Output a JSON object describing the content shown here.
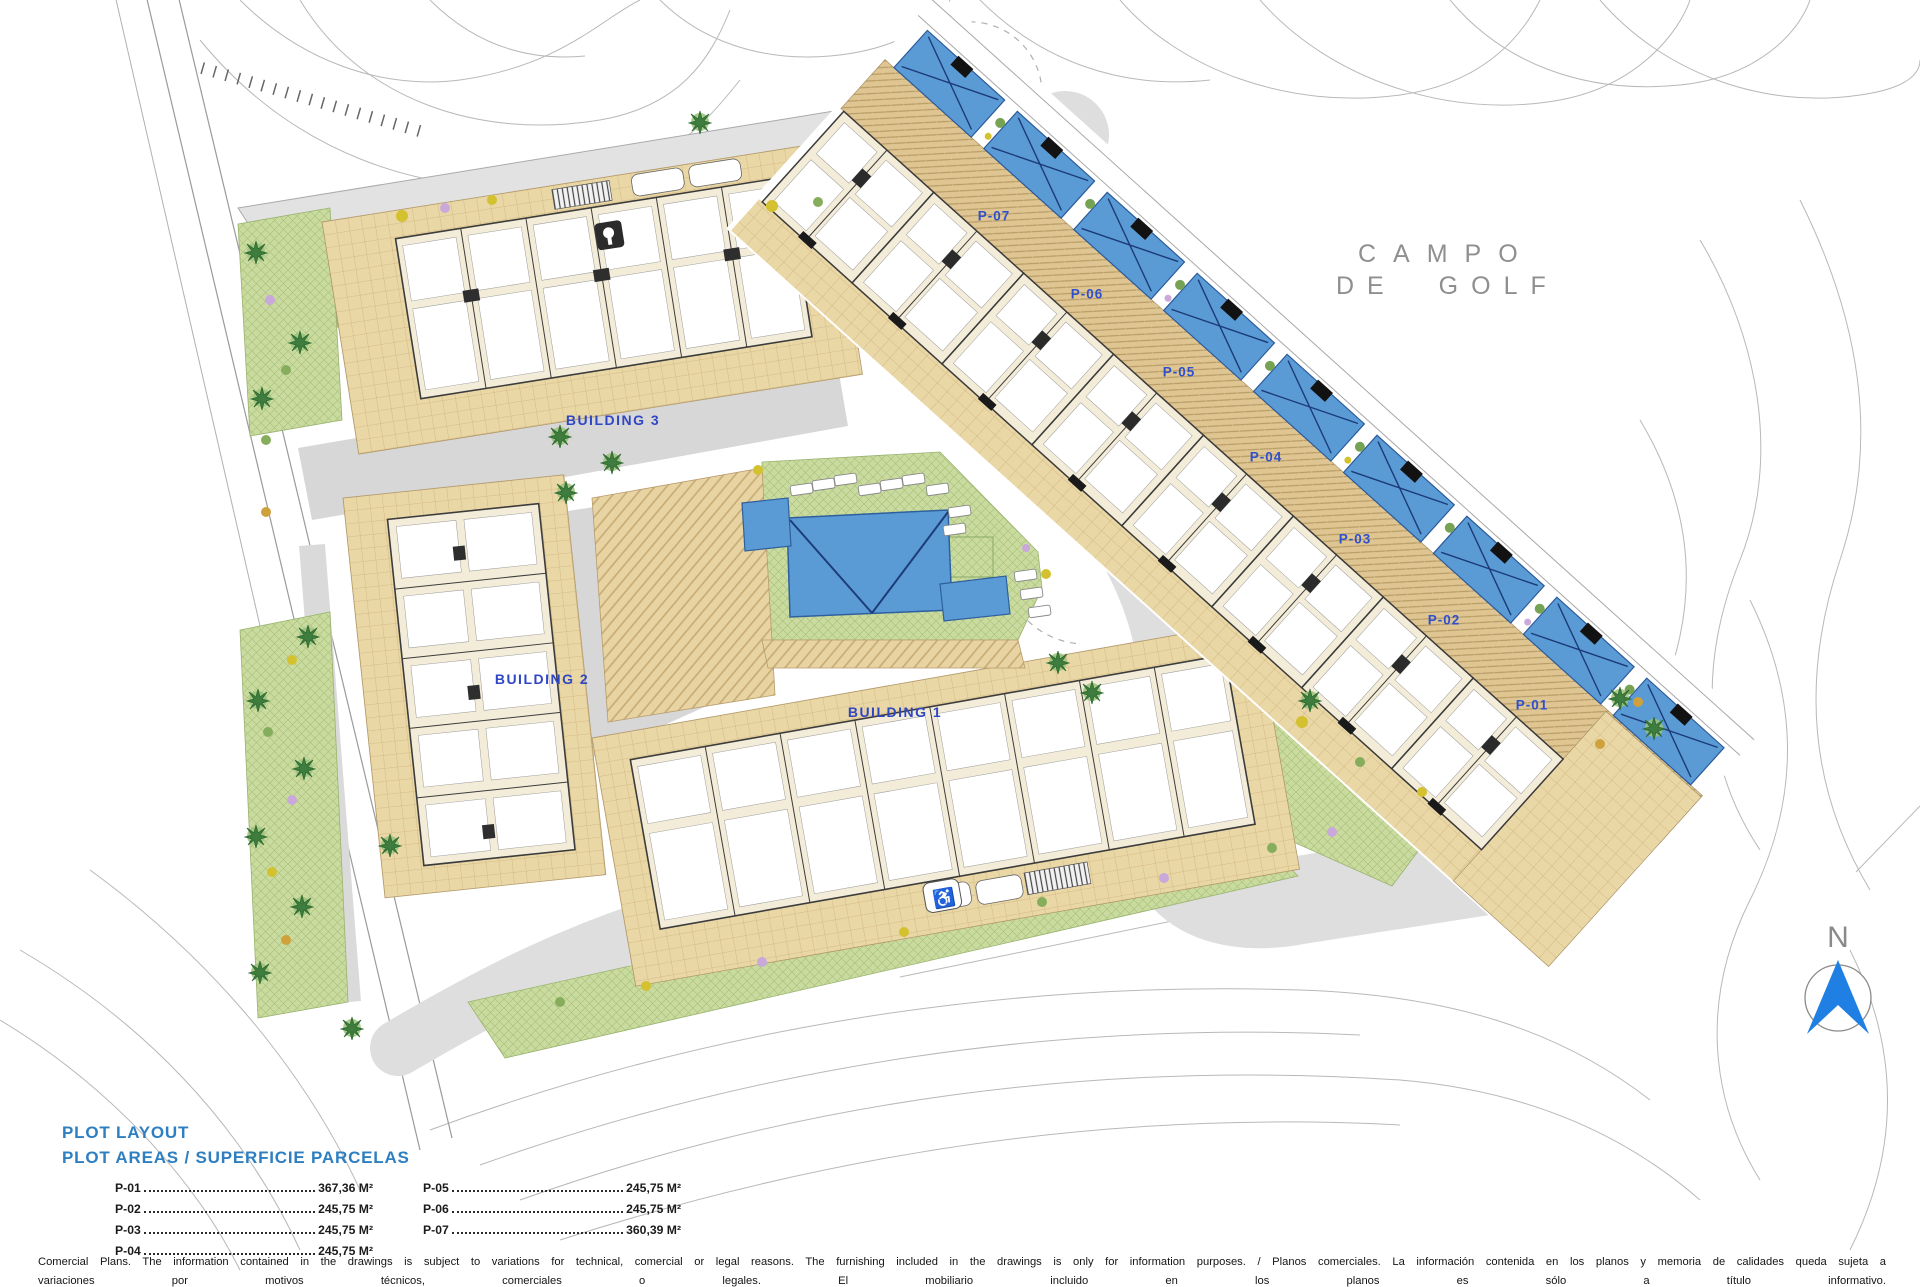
{
  "plan": {
    "buildings": [
      {
        "label": "BUILDING 3"
      },
      {
        "label": "BUILDING 2"
      },
      {
        "label": "BUILDING 1"
      }
    ],
    "plots": [
      {
        "label": "P-07"
      },
      {
        "label": "P-06"
      },
      {
        "label": "P-05"
      },
      {
        "label": "P-04"
      },
      {
        "label": "P-03"
      },
      {
        "label": "P-02"
      },
      {
        "label": "P-01"
      }
    ],
    "golf_course": {
      "line1": "CAMPO",
      "line2": "DE GOLF"
    },
    "north": {
      "label": "N"
    }
  },
  "icons": {
    "accessible_parking": "♿"
  },
  "colors": {
    "pool_blue": "#5b9bd5",
    "label_blue": "#2f50cc",
    "legend_blue": "#2d7fc1",
    "north_blue": "#1f7fe3"
  },
  "legend": {
    "title": "PLOT LAYOUT",
    "subtitle": "PLOT AREAS / SUPERFICIE PARCELAS",
    "columns": [
      [
        {
          "label": "P-01",
          "value": "367,36 M²"
        },
        {
          "label": "P-02",
          "value": "245,75 M²"
        },
        {
          "label": "P-03",
          "value": "245,75 M²"
        },
        {
          "label": "P-04",
          "value": "245,75 M²"
        }
      ],
      [
        {
          "label": "P-05",
          "value": "245,75 M²"
        },
        {
          "label": "P-06",
          "value": "245,75 M²"
        },
        {
          "label": "P-07",
          "value": "360,39 M²"
        }
      ]
    ]
  },
  "footer": {
    "line1": "Comercial Plans. The information contained in the drawings is subject to variations for technical, comercial or legal reasons. The furnishing included in the drawings is only for information purposes. / Planos comerciales. La información contenida en los planos y memoria de calidades queda sujeta a",
    "line2": "variaciones por motivos técnicos, comerciales o legales. El mobiliario incluido en los planos es sólo a título informativo."
  }
}
